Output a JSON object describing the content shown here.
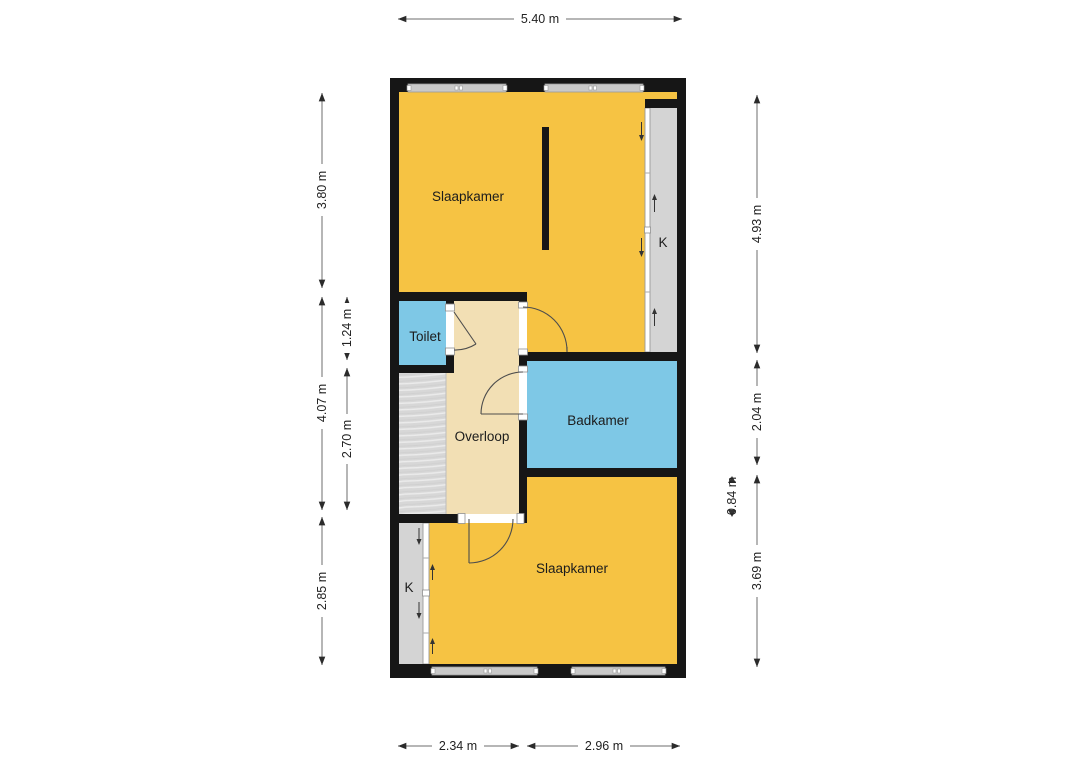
{
  "floorplan": {
    "type": "floor-plan",
    "rooms": [
      {
        "name": "Slaapkamer",
        "kind": "bedroom-top"
      },
      {
        "name": "Toilet",
        "kind": "toilet"
      },
      {
        "name": "Overloop",
        "kind": "landing"
      },
      {
        "name": "Badkamer",
        "kind": "bathroom"
      },
      {
        "name": "Slaapkamer",
        "kind": "bedroom-bottom"
      },
      {
        "name": "K",
        "kind": "closet-top-right"
      },
      {
        "name": "K",
        "kind": "closet-bottom-left"
      }
    ],
    "dimensions": {
      "top": [
        "5.40 m"
      ],
      "bottom": [
        "2.34 m",
        "2.96 m"
      ],
      "left": [
        "3.80 m",
        "4.07 m",
        "2.85 m",
        "1.24 m",
        "2.70 m"
      ],
      "right": [
        "4.93 m",
        "2.04 m",
        "3.69 m",
        "0.84 m"
      ]
    },
    "colors": {
      "room_yellow": "#F6C343",
      "room_blue": "#7EC8E6",
      "room_tan": "#F2DFB4",
      "closet_gray": "#D4D4D4",
      "stairs_gray": "#D7D7D7",
      "wall_black": "#161616",
      "dimension_text": "#222222"
    }
  }
}
